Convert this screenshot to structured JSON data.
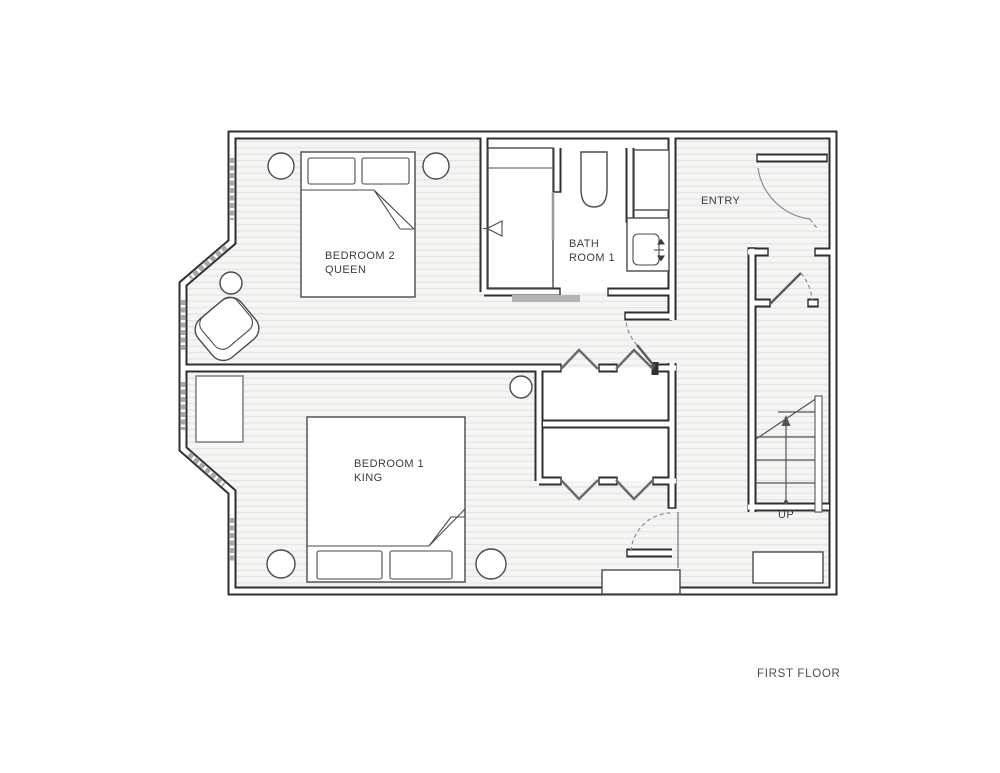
{
  "page": {
    "title_label": "FIRST FLOOR"
  },
  "rooms": {
    "bedroom2": {
      "name": "BEDROOM 2",
      "bed_size": "QUEEN"
    },
    "bathroom1": {
      "name_line1": "BATH",
      "name_line2": "ROOM 1"
    },
    "entry": {
      "name": "ENTRY"
    },
    "bedroom1": {
      "name": "BEDROOM 1",
      "bed_size": "KING"
    },
    "staircase": {
      "direction_label": "UP"
    }
  },
  "colors": {
    "wall_line": "#2f2f2f",
    "floor_background": "#f5f5f4",
    "floor_plank_line": "#e3e3e2",
    "window_glass": "#a8a8a8",
    "door_arc": "#8f8f8f",
    "furniture_line": "#4a4a4a",
    "label_text": "#3b3b3b"
  }
}
